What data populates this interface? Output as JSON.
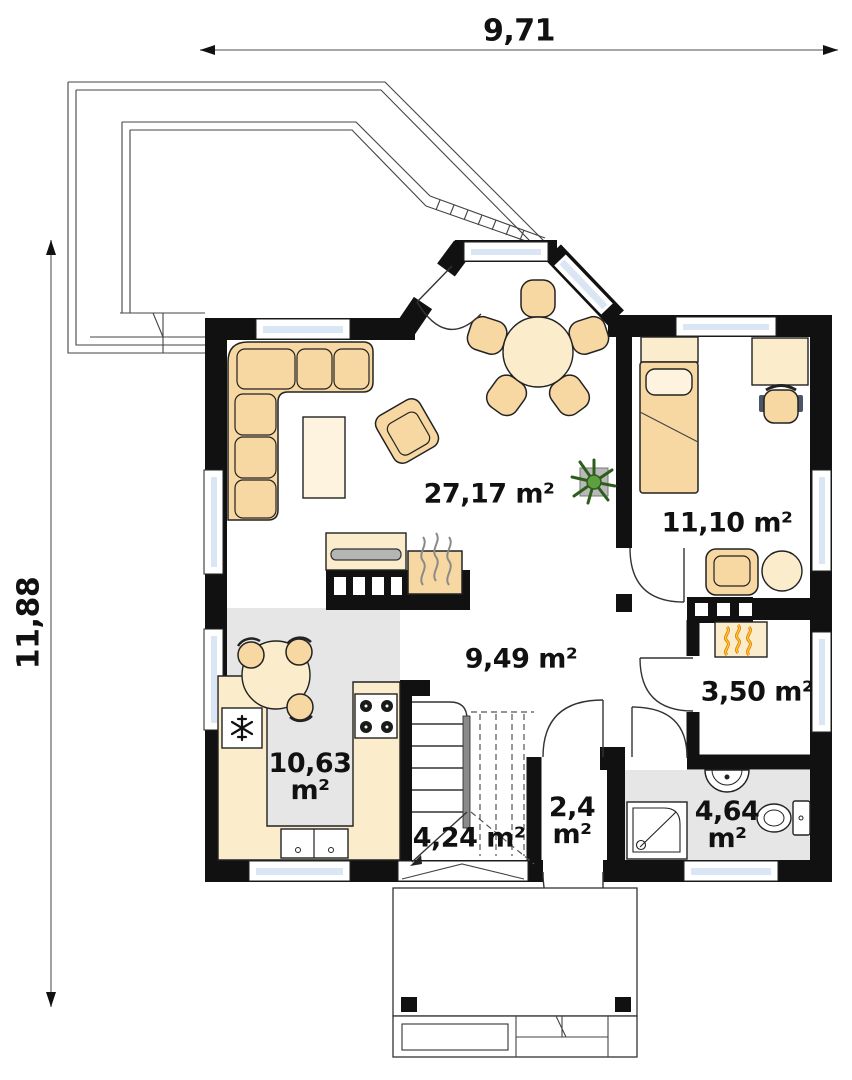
{
  "dimensions": {
    "width_label": "9,71",
    "height_label": "11,88"
  },
  "rooms": {
    "living_room": {
      "area_label": "27,17 m²"
    },
    "bedroom": {
      "area_label": "11,10 m²"
    },
    "hall": {
      "area_label": "9,49 m²"
    },
    "boiler_room": {
      "area_label": "3,50 m²"
    },
    "staircase": {
      "area_label": "4,24 m²"
    },
    "kitchen": {
      "area_value": "10,63",
      "area_unit": "m²"
    },
    "vestibule": {
      "area_value": "2,4",
      "area_unit": "m²"
    },
    "bathroom": {
      "area_value": "4,64",
      "area_unit": "m²"
    }
  },
  "colors": {
    "wall": "#111111",
    "furniture_tan": "#f7d8a2",
    "furniture_cream": "#fbeccb",
    "floor_gray": "#e6e6e6",
    "glass_blue": "#dbe6f5",
    "flame_orange": "#e07b00",
    "flame_yellow": "#ffc832",
    "plant_green": "#3a7a24"
  }
}
